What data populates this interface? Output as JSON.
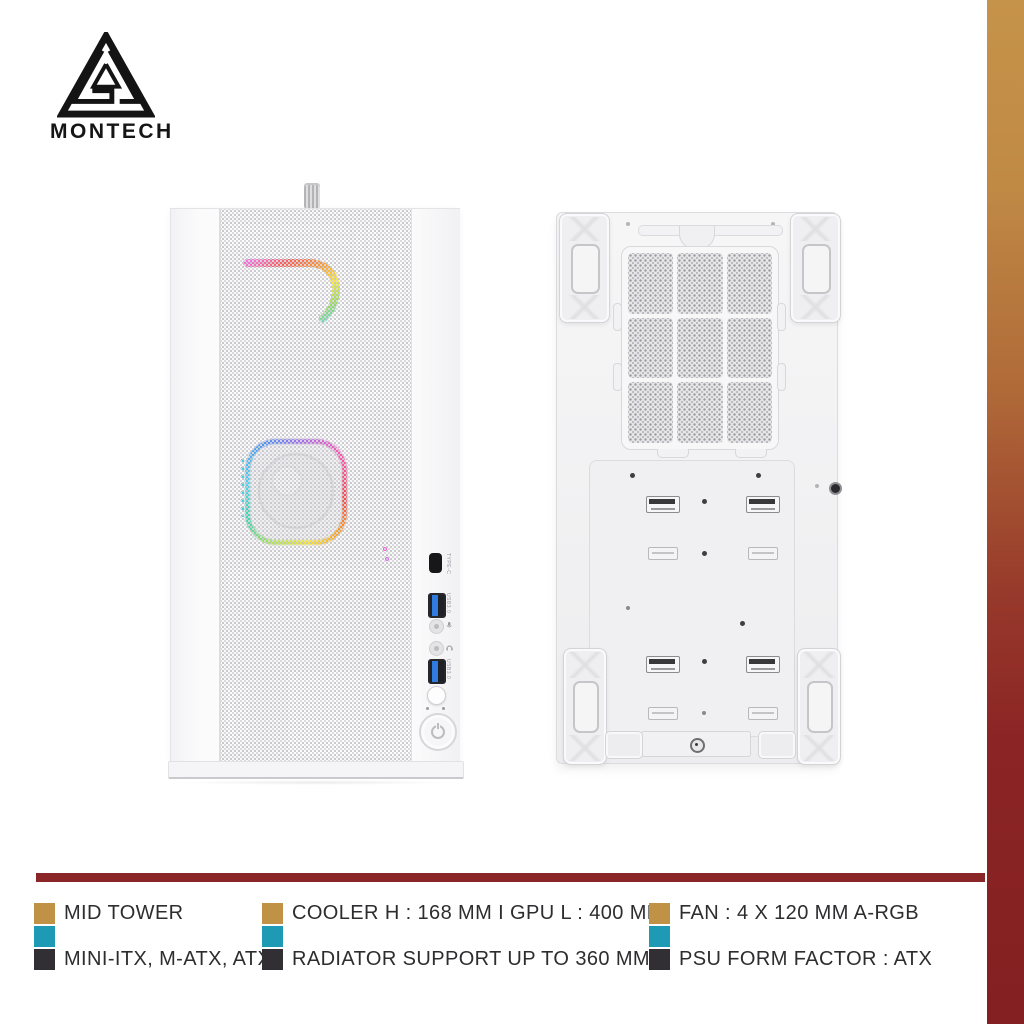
{
  "brand": {
    "wordmark": "MONTECH"
  },
  "colors": {
    "accent_gold": "#C09246",
    "accent_teal": "#1F9AB4",
    "accent_charcoal": "#312F33",
    "divider_maroon": "#8A2628",
    "side_gradient_top": "#C6934A",
    "side_gradient_bottom": "#842021"
  },
  "front_io": {
    "type_c_label": "TYPE-C",
    "usb_top_label": "USB3.0",
    "usb_bottom_label": "USB3.0"
  },
  "specs": {
    "items": [
      {
        "line1": "MID TOWER",
        "line2": "MINI-ITX, M-ATX, ATX"
      },
      {
        "line1": "COOLER H : 168 MM I GPU L : 400 MM",
        "line2": "RADIATOR SUPPORT UP TO 360 MM"
      },
      {
        "line1": "FAN : 4 X 120 MM A-RGB",
        "line2": "PSU FORM FACTOR : ATX"
      }
    ]
  }
}
